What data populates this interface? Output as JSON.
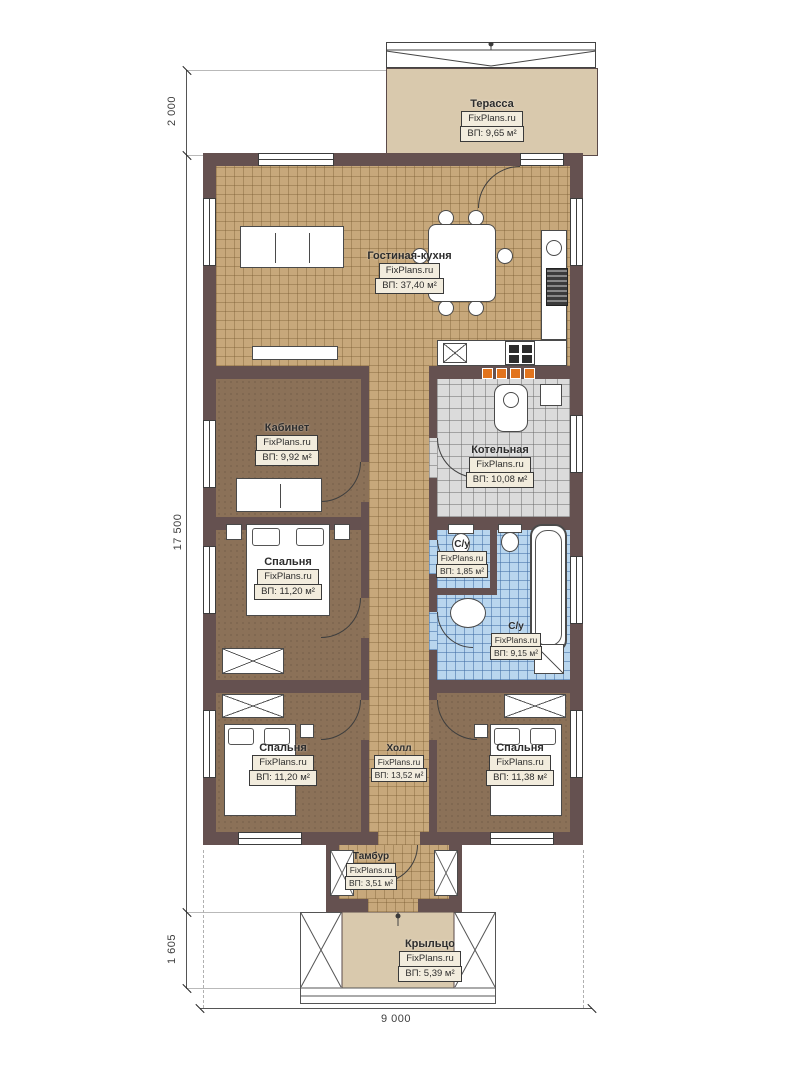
{
  "brand": "FixPlans.ru",
  "dimensions": {
    "terrace_depth": "2 000",
    "house_length": "17 500",
    "porch_depth": "1 605",
    "house_width": "9 000"
  },
  "rooms": [
    {
      "id": "terrace",
      "name": "Терасса",
      "brand": "FixPlans.ru",
      "area": "ВП: 9,65 м²"
    },
    {
      "id": "living",
      "name": "Гостиная-кухня",
      "brand": "FixPlans.ru",
      "area": "ВП: 37,40 м²"
    },
    {
      "id": "office",
      "name": "Кабинет",
      "brand": "FixPlans.ru",
      "area": "ВП: 9,92 м²"
    },
    {
      "id": "boiler",
      "name": "Котельная",
      "brand": "FixPlans.ru",
      "area": "ВП: 10,08 м²"
    },
    {
      "id": "bedroom1",
      "name": "Спальня",
      "brand": "FixPlans.ru",
      "area": "ВП: 11,20 м²"
    },
    {
      "id": "wc1",
      "name": "С/у",
      "brand": "FixPlans.ru",
      "area": "ВП: 1,85 м²"
    },
    {
      "id": "wc2",
      "name": "С/у",
      "brand": "FixPlans.ru",
      "area": "ВП: 9,15 м²"
    },
    {
      "id": "bedroom2",
      "name": "Спальня",
      "brand": "FixPlans.ru",
      "area": "ВП: 11,20 м²"
    },
    {
      "id": "hall",
      "name": "Холл",
      "brand": "FixPlans.ru",
      "area": "ВП: 13,52 м²"
    },
    {
      "id": "bedroom3",
      "name": "Спальня",
      "brand": "FixPlans.ru",
      "area": "ВП: 11,38 м²"
    },
    {
      "id": "tambur",
      "name": "Тамбур",
      "brand": "FixPlans.ru",
      "area": "ВП: 3,51 м²"
    },
    {
      "id": "porch",
      "name": "Крыльцо",
      "brand": "FixPlans.ru",
      "area": "ВП: 5,39 м²"
    }
  ],
  "colors": {
    "wall": "#655150",
    "floor_tile_tan": "#c7a87b",
    "floor_room_brown": "#8b7158",
    "floor_tile_gray": "#dbdbdb",
    "floor_tile_blue": "#b9d6ee",
    "terrace": "#d9c9ad",
    "accent_orange": "#e2731c"
  }
}
